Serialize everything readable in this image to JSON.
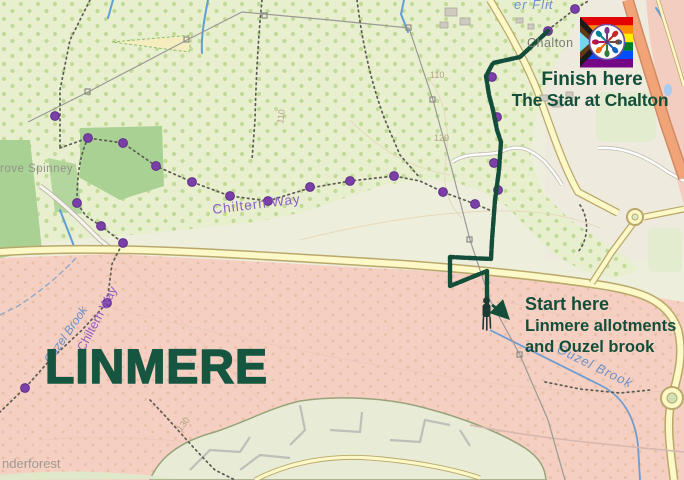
{
  "map": {
    "title": "Walking route map from Linmere to The Star at Chalton",
    "labels": {
      "linmere": "LINMERE",
      "chiltern_way": "Chiltern Way",
      "ouzel_brook": "Ouzel Brook",
      "grove_spinney_partial": "rove Spinney",
      "chalton": "Chalton",
      "river_flit_partial": "er Flit",
      "wanderforest_partial": "nderforest",
      "contour_110": "110",
      "contour_120": "120",
      "contour_130": "130"
    },
    "annotations": {
      "finish": {
        "line1": "Finish here",
        "line2": "The Star at Chalton"
      },
      "start": {
        "line1": "Start here",
        "line2": "Linmere allotments",
        "line3": "and Ouzel brook"
      }
    },
    "icons": {
      "logo": "pride-flag-pub-logo",
      "walker": "walker-icon",
      "arrow": "start-arrow-icon",
      "trail_marker": "purple-trail-marker-dot"
    },
    "colors": {
      "route_green": "#134e3a",
      "annotation_green": "#155641",
      "trail_marker_purple": "#7b3faa",
      "linmere_overlay_pink": "#f5d0c2",
      "scrub_green": "#e8efcf",
      "road_yellow": "#fcf8c8",
      "trunk_road_orange": "#f0a478",
      "water_blue": "#6a90c8"
    }
  }
}
